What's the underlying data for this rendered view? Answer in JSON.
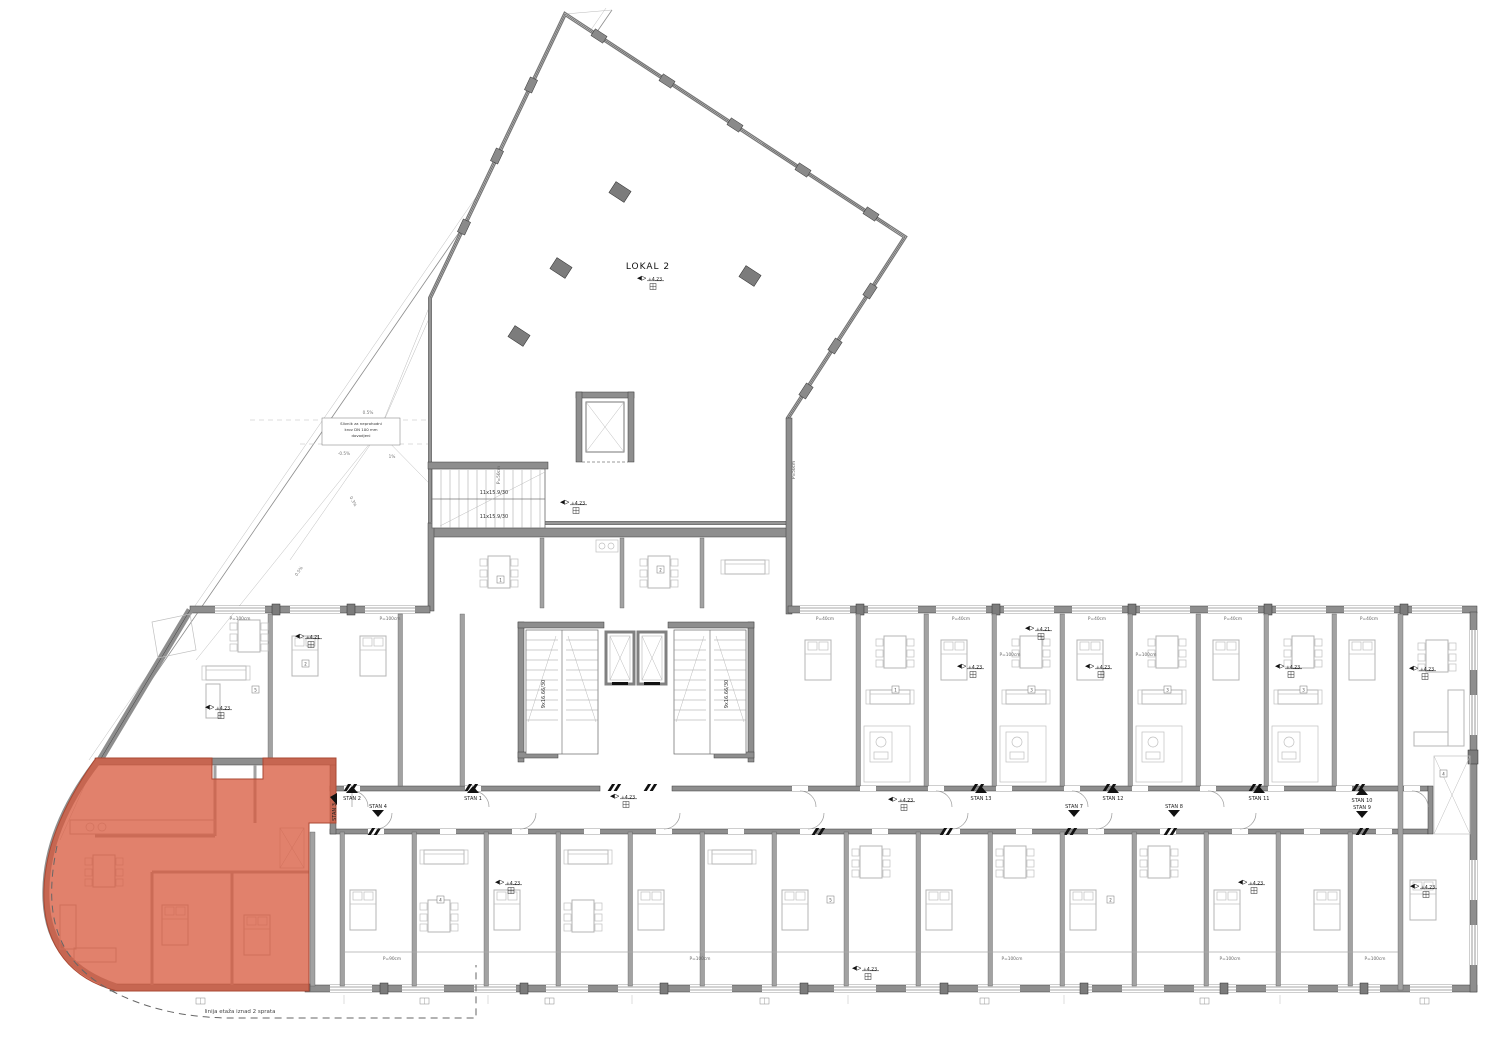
{
  "hall": {
    "label": "LOKAL 2"
  },
  "levels": {
    "main": "+4.23",
    "alt": "+4.21"
  },
  "stairs": {
    "upper_run": "11x15.9/30",
    "core_run": "9x16.66/30"
  },
  "apartments": [
    {
      "label": "STAN 1"
    },
    {
      "label": "STAN 2"
    },
    {
      "label": "STAN 3"
    },
    {
      "label": "STAN 4"
    },
    {
      "label": "STAN 7"
    },
    {
      "label": "STAN 8"
    },
    {
      "label": "STAN 9"
    },
    {
      "label": "STAN 10"
    },
    {
      "label": "STAN 11"
    },
    {
      "label": "STAN 12"
    },
    {
      "label": "STAN 13"
    }
  ],
  "notes": {
    "floor_line": "linija etaža iznad 2 sprata",
    "drain_line1": "Slivnik za neprohodni",
    "drain_line2": "krov DN 100 mm",
    "drain_line3": "dovodjeni"
  },
  "slopes": {
    "s1": "0.5%",
    "s2": "-0.5%",
    "s3": "1%",
    "s4": "0.3%"
  },
  "windows": {
    "p40": "P=40cm",
    "p50": "P=50cm",
    "p90": "P=90cm",
    "p100": "P=100cm"
  },
  "rooms": {
    "r1": "1",
    "r2": "2",
    "r3": "3",
    "r4": "4",
    "r5": "5"
  },
  "highlight_color": "#d85a3e"
}
